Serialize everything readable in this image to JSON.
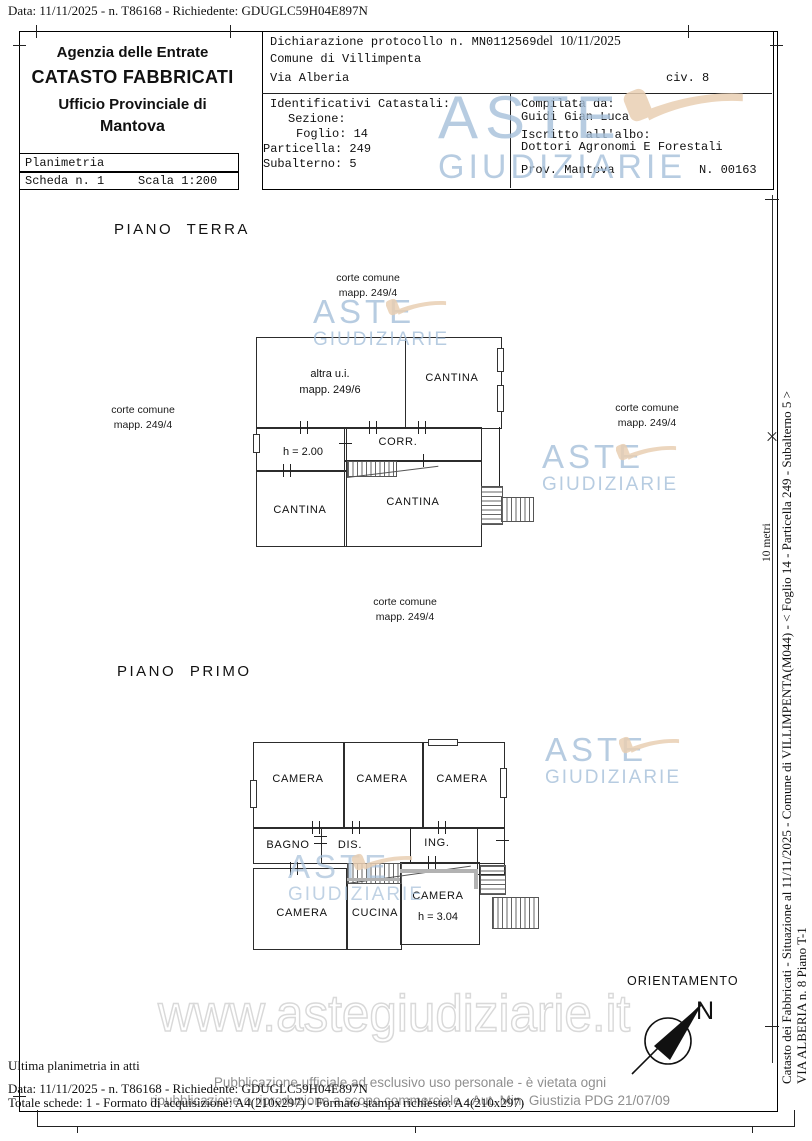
{
  "top_bar": "Data: 11/11/2025 - n. T86168 - Richiedente: GDUGLC59H04E897N",
  "header": {
    "agency": {
      "l1": "Agenzia delle Entrate",
      "l2": "CATASTO FABBRICATI",
      "l3": "Ufficio Provinciale di",
      "l4": "Mantova"
    },
    "planimetria": "Planimetria",
    "scheda": "Scheda n. 1",
    "scala": "Scala 1:200",
    "protocol": "Dichiarazione protocollo n. MN0112569",
    "protocol_del": "del  10/11/2025",
    "comune": "Comune di Villimpenta",
    "via": "Via Alberia",
    "civ": "civ. 8",
    "identificativi": {
      "title": "Identificativi Catastali:",
      "sezione": "Sezione:",
      "foglio": "Foglio: 14",
      "particella": "Particella: 249",
      "subalterno": "Subalterno: 5"
    },
    "compilata": {
      "label": "Compilata da:",
      "nome": "Guidi Gian Luca",
      "albo_label": "Iscritto all'albo:",
      "albo": "Dottori Agronomi E Forestali",
      "prov": "Prov. Mantova",
      "numero": "N. 00163"
    }
  },
  "corte": {
    "l1": "corte comune",
    "l2": "mapp. 249/4"
  },
  "terra": {
    "title": "PIANO TERRA",
    "altra1": "altra u.i.",
    "altra2": "mapp. 249/6",
    "cantina": "CANTINA",
    "corr": "CORR.",
    "h": "h = 2.00"
  },
  "primo": {
    "title": "PIANO PRIMO",
    "camera": "CAMERA",
    "bagno": "BAGNO",
    "dis": "DIS.",
    "ing": "ING.",
    "cucina": "CUCINA",
    "h": "h = 3.04"
  },
  "orientation": {
    "label": "ORIENTAMENTO",
    "north": "N"
  },
  "scalebar": {
    "label": "10 metri"
  },
  "watermark": {
    "aste": "ASTE",
    "giudiziarie": "GIUDIZIARIE",
    "site": "www.astegiudiziarie.it"
  },
  "side_caption": {
    "line1": "Catasto dei Fabbricati - Situazione al 11/11/2025 - Comune di VILLIMPENTA(M044) - <  Foglio 14 - Particella  249 - Subalterno 5 >",
    "line2": "VIA ALBERIA n. 8 Piano T-1"
  },
  "footer": {
    "ultima": "Ultima planimetria in atti",
    "pub1": "Pubblicazione ufficiale ad esclusivo uso personale - è vietata ogni",
    "pub2": "ripubblicazione o riproduzione a scopo commerciale - Aut. Min. Giustizia PDG 21/07/09",
    "data_line": "Data: 11/11/2025 - n. T86168 - Richiedente: GDUGLC59H04E897N",
    "totale": "Totale schede: 1 - Formato di acquisizione: A4(210x297) - Formato stampa richiesto: A4(210x297)"
  },
  "colors": {
    "watermark_blue": "#a6c0da",
    "gavel_tan": "#e9cfb3",
    "footer_gray": "#8f8f8f",
    "outline_gray": "#d9d9d9"
  }
}
